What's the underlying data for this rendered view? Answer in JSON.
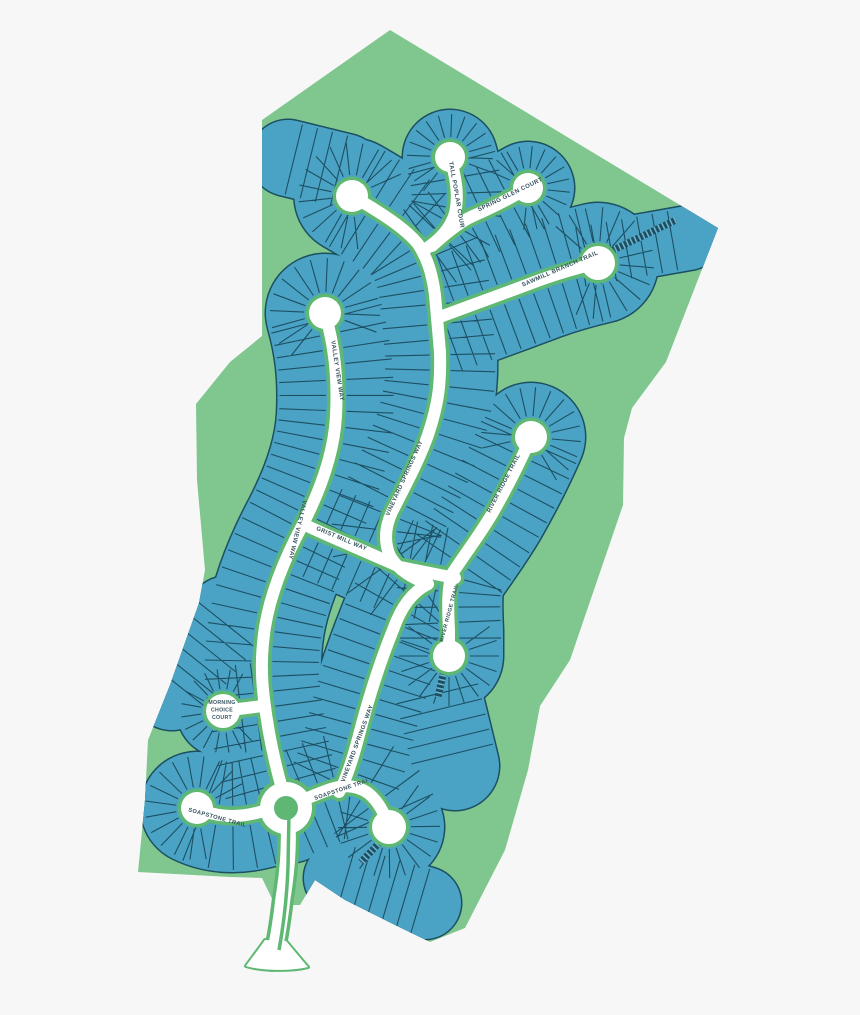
{
  "page": {
    "background": "#f7f7f7"
  },
  "map": {
    "title": "Residential community site plan",
    "streets": [
      "Tall Poplar Court",
      "Spring Glen Court",
      "Sawmill Branch Trail",
      "Valley View Way",
      "Vineyard Springs Way",
      "River Ridge Trail",
      "Grist Mill Way",
      "Morning Choice Court",
      "Soapstone Trail"
    ],
    "colors": {
      "background": "#f7f7f7",
      "parcel": "#80c78f",
      "casing": "#5eb873",
      "road": "#ffffff",
      "lot": "#4aa3c4",
      "lot_line": "#1d4f63",
      "hatch_rung": "#6db4cd",
      "label": "#35525e"
    },
    "parcel": "M262,120 L390,30 L718,228 L666,362 L632,408 L624,438 L623,505 L570,660 L540,706 L528,770 L505,850 L465,928 L430,942 L395,925 L345,900 L315,880 L300,905 L275,905 L262,878 L230,877 L138,872 L145,800 L148,740 L170,685 L199,603 L205,570 L197,480 L196,404 L230,362 L262,336 Z",
    "defaults": {
      "road": 12,
      "casing": 19,
      "band": 112,
      "bulbR": 16,
      "tick_step": 15.5
    },
    "roads": [
      {
        "id": "sawmill-branch-trail-west",
        "d": "M352,196 C380,212 405,228 418,244 C427,258 432,272 435,295 L437,318",
        "band": 115,
        "bulbs": [
          "start"
        ],
        "bulbR": 16
      },
      {
        "id": "sawmill-branch-trail-east",
        "d": "M437,318 C465,308 505,293 540,280 C565,271 585,266 598,263",
        "band": 120,
        "bulbs": [
          "end"
        ],
        "bulbR": 17
      },
      {
        "id": "vineyard-springs-way-north",
        "d": "M437,318 L440,352 C441,385 438,405 428,435 C418,463 403,490 392,512 C385,527 384,542 390,556 C398,570 412,578 428,584",
        "band": 114
      },
      {
        "id": "vineyard-springs-way-south",
        "d": "M428,584 C412,592 401,607 393,630 C380,662 368,700 359,735 C352,762 346,780 339,792",
        "band": 112
      },
      {
        "id": "valley-view-way",
        "d": "M325,313 C334,345 338,375 336,416 C334,452 321,489 303,524 C287,554 271,590 265,627 C261,654 261,675 264,699 C268,732 274,761 283,792 L286,801",
        "band": 118,
        "bulbs": [
          "start"
        ],
        "bulbR": 16
      },
      {
        "id": "grist-mill-way",
        "d": "M303,524 C330,537 365,551 400,567 L455,578",
        "band": 100
      },
      {
        "id": "river-ridge-trail",
        "d": "M531,437 C522,458 508,486 492,514 C477,539 462,558 452,574 C447,589 448,610 449,631 L449,656",
        "band": 108,
        "bulbs": [
          "start",
          "end"
        ],
        "bulbR": 16
      },
      {
        "id": "tall-poplar-court",
        "d": "M450,157 C456,178 459,196 455,213 C451,227 440,240 424,250",
        "band": 94,
        "bulbs": [
          "start"
        ],
        "bulbR": 15
      },
      {
        "id": "spring-glen-court",
        "d": "M528,188 C511,198 491,208 473,216 C459,222 444,235 432,246",
        "band": 92,
        "bulbs": [
          "start"
        ],
        "bulbR": 15
      },
      {
        "id": "morning-choice-court",
        "d": "M262,706 C248,708 237,709 223,711",
        "band": 92,
        "bulbs": [
          "end"
        ],
        "bulbR": 17
      },
      {
        "id": "soapstone-trail-west",
        "d": "M197,808 C215,817 236,818 256,813 C268,810 277,808 287,807",
        "band": 112,
        "bulbs": [
          "start"
        ],
        "bulbR": 16
      },
      {
        "id": "soapstone-trail-east",
        "d": "M287,807 C301,801 316,794 331,789 C346,784 358,786 368,793 C378,801 384,812 389,827",
        "band": 110,
        "bulbs": [
          "end"
        ],
        "bulbR": 17
      },
      {
        "id": "entrance-drive",
        "d": "M287,807 C290,838 288,868 283,898 C280,924 277,944 272,961",
        "road": 15,
        "casing": 22,
        "band": 0
      },
      {
        "id": "lot-block-northeast",
        "d": "M575,258 L688,238",
        "band": 64,
        "noRoad": true
      },
      {
        "id": "lot-block-north",
        "d": "M288,158 L345,172",
        "band": 76,
        "noRoad": true
      },
      {
        "id": "lot-block-southeast",
        "d": "M340,878 L425,903",
        "band": 72,
        "noRoad": true
      },
      {
        "id": "lot-block-mid-south",
        "d": "M436,688 L455,766",
        "band": 88,
        "noRoad": true
      },
      {
        "id": "lot-block-west",
        "d": "M172,688 L228,618",
        "band": 84,
        "noRoad": true
      }
    ],
    "roundabout": {
      "cx": 286,
      "cy": 808,
      "casing_r": 30,
      "white_r": 26,
      "island_r": 12
    },
    "entrance_flare": "M265,940 C258,950 251,959 246,966 C262,971 292,971 308,967 C300,958 292,948 286,941 Z",
    "median": "M289,814 L288,866 C287,898 283,928 279,950",
    "hatches": [
      {
        "id": "easement-northeast",
        "d": "M603,255 L676,220"
      },
      {
        "id": "easement-south",
        "d": "M446,662 L438,697"
      },
      {
        "id": "easement-southeast",
        "d": "M381,841 L361,862"
      }
    ],
    "labels": [
      {
        "id": "lbl-tall-poplar",
        "text": "TALL POPLAR COURT",
        "d": "M449,162 L461,230",
        "size": 6,
        "offset": 0
      },
      {
        "id": "lbl-spring-glen",
        "text": "SPRING GLEN COURT",
        "d": "M478,212 L542,181",
        "size": 6,
        "offset": 1
      },
      {
        "id": "lbl-sawmill",
        "text": "SAWMILL BRANCH TRAIL",
        "d": "M520,288 L601,253",
        "size": 6,
        "offset": 3
      },
      {
        "id": "lbl-valley-view-top",
        "text": "VALLEY VIEW WAY",
        "d": "M330,333 L342,412",
        "size": 6,
        "offset": 8
      },
      {
        "id": "lbl-valley-view-mid",
        "text": "VALLEY VIEW WAY",
        "d": "M305,492 L286,570",
        "size": 6,
        "offset": 8
      },
      {
        "id": "lbl-vineyard-north",
        "text": "VINEYARD SPRINGS WAY",
        "d": "M384,527 L428,430",
        "size": 6,
        "offset": 12
      },
      {
        "id": "lbl-vineyard-south",
        "text": "VINEYARD SPRINGS WAY",
        "d": "M342,789 L376,698",
        "size": 6,
        "offset": 7
      },
      {
        "id": "lbl-river-ridge-north",
        "text": "RIVER RIDGE TRAIL",
        "d": "M486,521 L527,442",
        "size": 6,
        "offset": 9
      },
      {
        "id": "lbl-river-ridge-south",
        "text": "RIVER RIDGE TRAIL",
        "d": "M443,642 L459,582",
        "size": 5.4,
        "offset": 0
      },
      {
        "id": "lbl-grist-mill",
        "text": "GRIST MILL WAY",
        "d": "M314,529 L369,552",
        "size": 6,
        "offset": 2
      },
      {
        "id": "lbl-soapstone-west",
        "text": "SOAPSTONE TRAIL",
        "d": "M187,811 L245,827",
        "size": 5.7,
        "offset": 1
      },
      {
        "id": "lbl-soapstone-east",
        "text": "SOAPSTONE TRAIL",
        "d": "M315,800 L369,782",
        "size": 5.7,
        "offset": 0
      }
    ],
    "court_label": {
      "lines": [
        "MORNING",
        "CHOICE",
        "COURT"
      ],
      "x": 222,
      "y": 704,
      "line_height": 7.5,
      "size": 5.2
    }
  }
}
